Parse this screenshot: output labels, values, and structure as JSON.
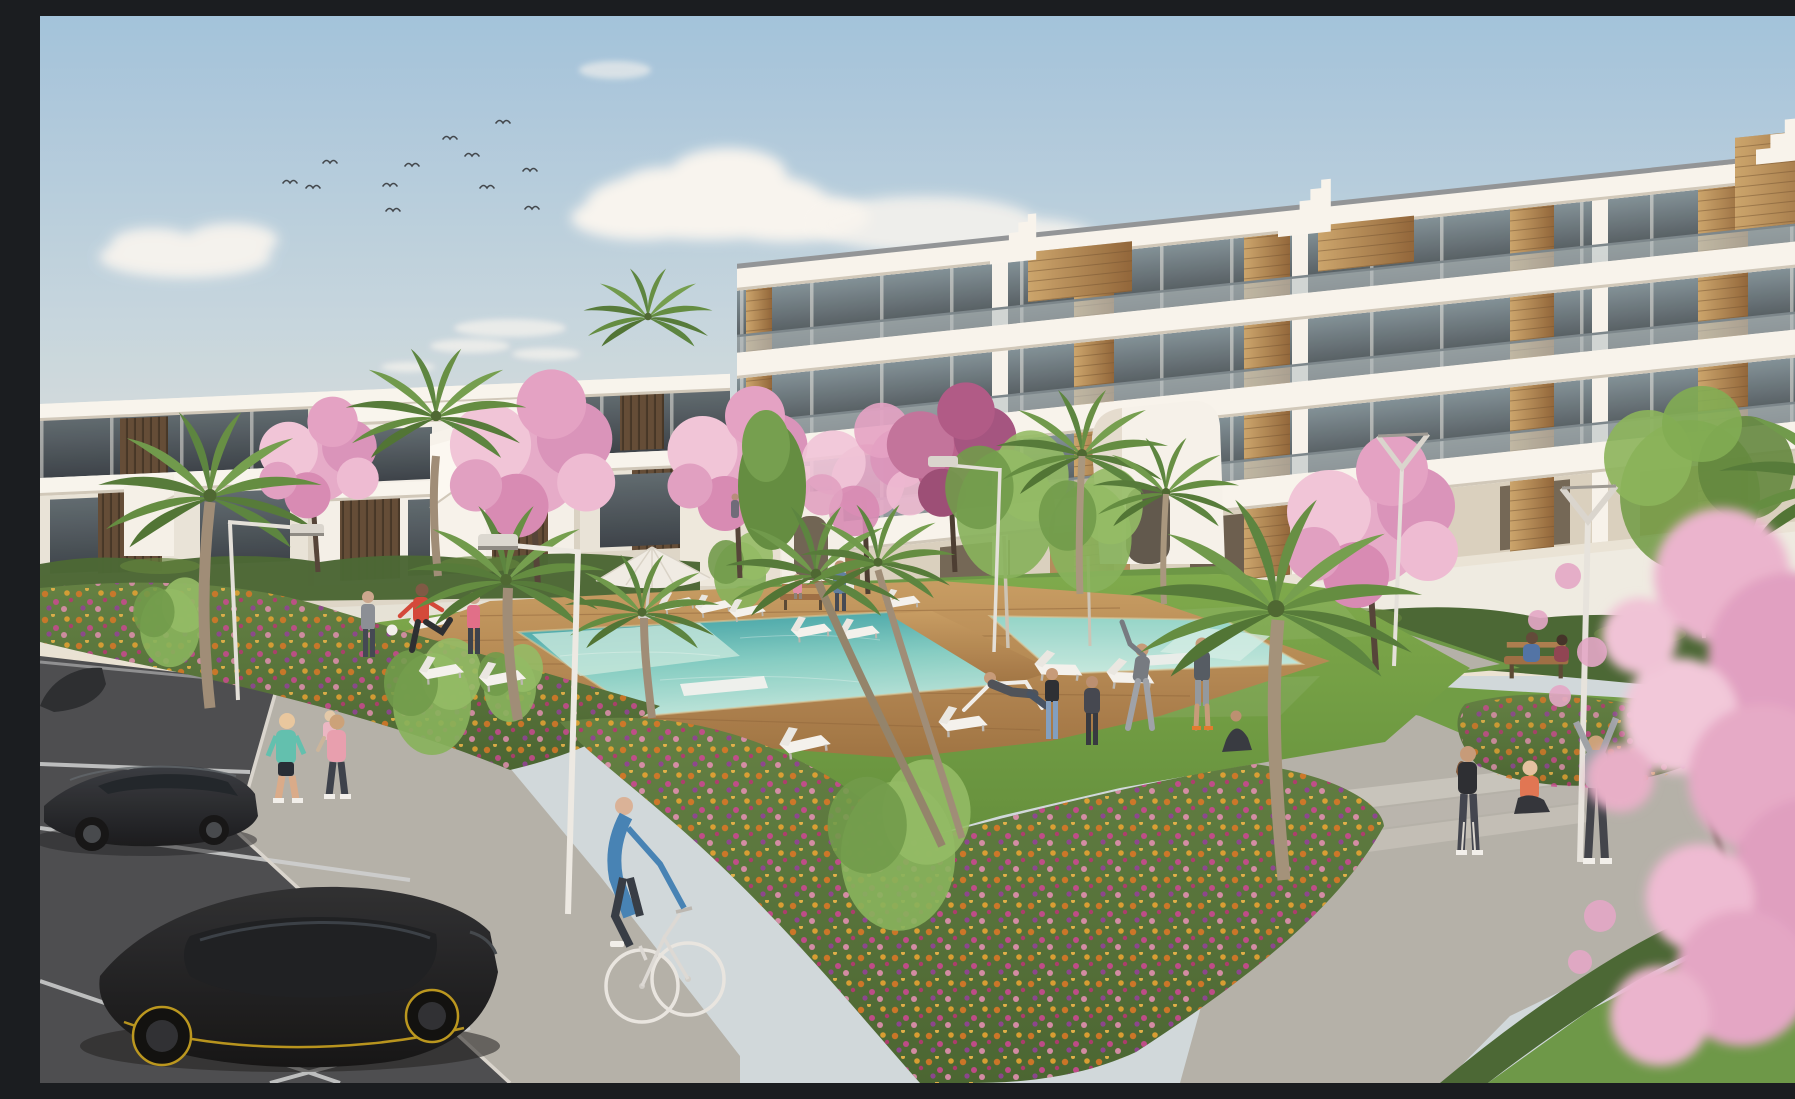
{
  "meta": {
    "title": "Residential complex exterior visualization",
    "description": "Architectural rendering of a modern white apartment complex: a four-storey block with wood-clad columns and glass balconies on the right, two-storey terraced apartments on the left, a communal lawn with an L-shaped turquoise pool on a timber deck, white sun loungers and a parasol, pink cherry-blossom trees, palms, flower beds in orange and magenta, paved walkways, a parking area with dark cars, a cyclist, joggers and residents exercising under a pale blue sky with a flock of birds."
  },
  "palette": {
    "sky_top": "#9fc2dd",
    "sky_horizon": "#eae3d4",
    "cloud": "#f8f6f2",
    "building_white": "#f6f3ec",
    "building_band": "#f8f5ef",
    "building_shadow": "#d9d2c5",
    "glass_dark": "#49545b",
    "wood_accent": "#b4884e",
    "balustrade_glass": "#b7c3c7",
    "lawn": "#6f9f42",
    "hedge": "#43622f",
    "bed_green": "#52703a",
    "flower_orange": "#d8721f",
    "flower_magenta": "#c8418f",
    "flower_purple": "#8e3a96",
    "blossom": "#e3a6c8",
    "pool_deep": "#2f98a0",
    "pool_shallow": "#b8e4da",
    "deck_wood": "#b5854f",
    "pavement": "#b2afa8",
    "asphalt": "#45474b",
    "car_black": "#111316",
    "accent_yellow": "#c8a018"
  },
  "scene": {
    "sky": {
      "clouds": 6,
      "birds": 12
    },
    "buildings": {
      "right_block": {
        "storeys": 4,
        "features": [
          "white balcony bands",
          "glass balustrades",
          "wood-clad columns",
          "roof terraces with timber boxes",
          "stepped stair parapets",
          "entrance stair tower with arch"
        ]
      },
      "left_block": {
        "storeys": 2,
        "features": [
          "white parapets",
          "dark glazing",
          "timber slat panels",
          "external white staircase"
        ]
      }
    },
    "amenities": {
      "pool": {
        "shape": "L-shaped",
        "deck": "timber",
        "in_pool_benches": 2
      },
      "parasols": 1,
      "sun_loungers": 13,
      "benches": 2,
      "street_lamps": 5
    },
    "vegetation": {
      "palm_trees": 11,
      "cherry_blossom_trees": 7,
      "green_trees": 8,
      "hedge_rows": 5,
      "flower_beds": 3,
      "flower_colors": [
        "orange",
        "magenta",
        "purple",
        "pale pink"
      ]
    },
    "people": {
      "total": 21,
      "activities": [
        "jogging",
        "cycling",
        "stretching",
        "kicking a ball",
        "reclining on a deck chair",
        "sitting on benches",
        "walking",
        "yoga on the grass"
      ]
    },
    "vehicles": {
      "parked_cars": 3,
      "bicycles": 1
    },
    "ground": {
      "parking_lines": 4,
      "paths": "paved walkways with steps",
      "lawn": "communal green"
    }
  }
}
